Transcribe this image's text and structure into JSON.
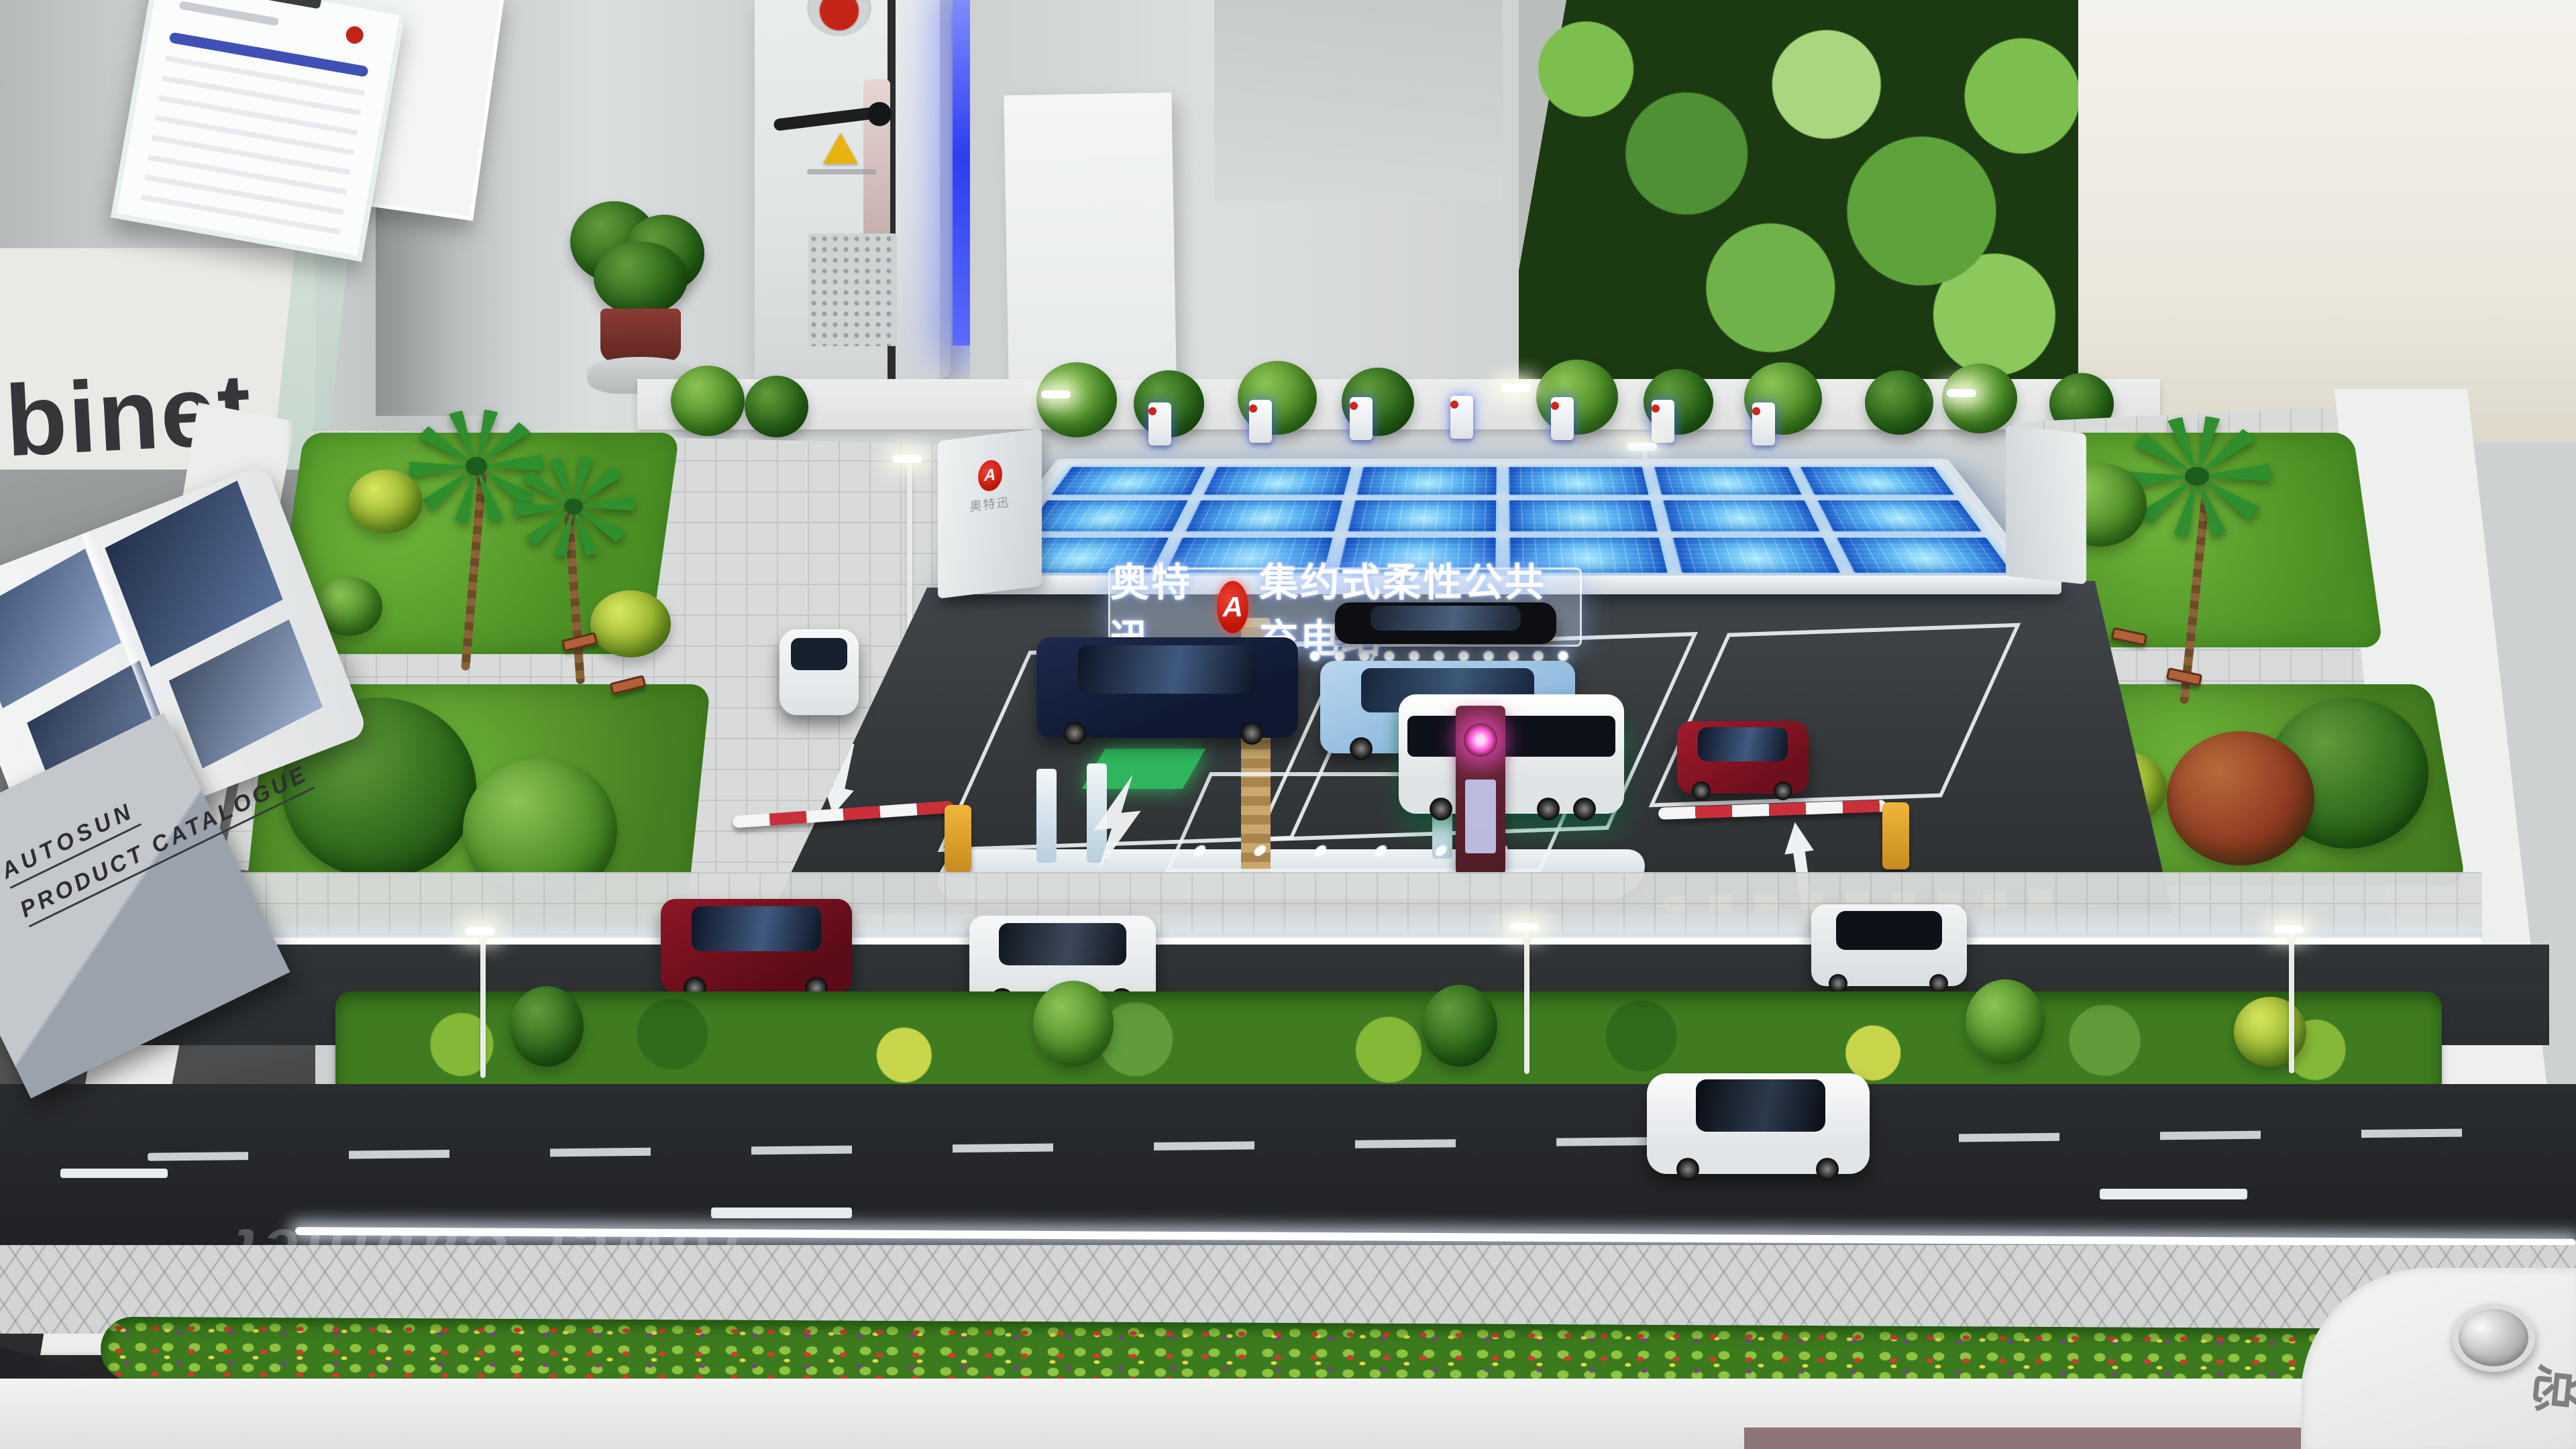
{
  "meta": {
    "scene": "Exhibition scale model of a solar-canopy EV public charging station",
    "brand_en": "AUTOSUN",
    "brand_cn": "奥特迅"
  },
  "background": {
    "wall_text_partial": "binet"
  },
  "catalog": {
    "brand_line": "AUTOSUN",
    "title_line": "PRODUCT CATALOGUE"
  },
  "canopy_sign": {
    "brand": "奥特迅",
    "logo_letter": "A",
    "station_name": "集约式柔性公共充电站"
  },
  "canopy_end": {
    "logo_letter": "A",
    "logo_text": "奥特迅"
  },
  "road_reflection": "Tower Cabinet",
  "base_corner_label": "总",
  "colors": {
    "solar_blue": "#2f9fe6",
    "solar_deep": "#0f55c4",
    "led_strip_blue": "#4653ff",
    "forecourt_asphalt": "#34383b",
    "road": "#26292c",
    "lawn_green": "#5ea32f",
    "accent_red": "#d0241a",
    "magenta_glow": "#ff4fd8",
    "canopy_white": "#e4eaec"
  }
}
